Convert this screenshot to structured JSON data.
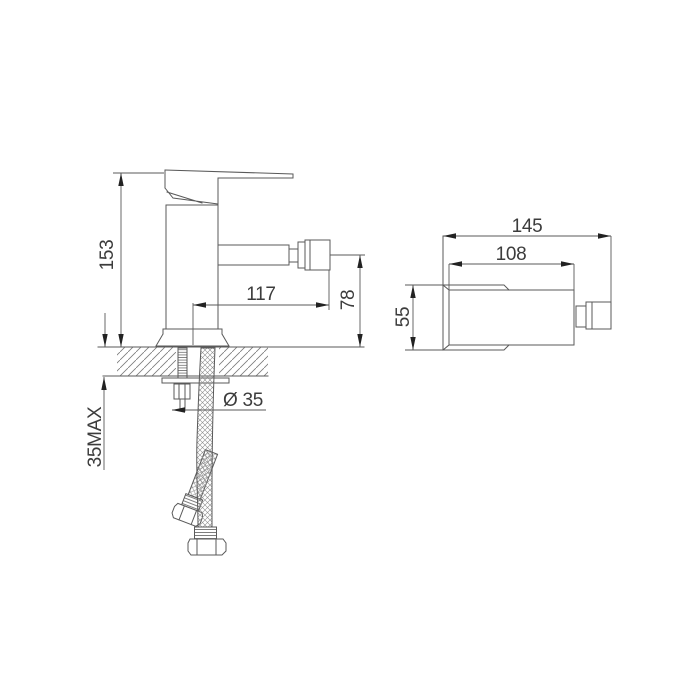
{
  "drawing": {
    "front_view": {
      "dim_height": "153",
      "dim_spout_reach": "117",
      "dim_spout_height": "78",
      "dim_max_deck_thickness": "35MAX",
      "dim_hole_diameter": "Ø 35"
    },
    "top_view": {
      "dim_overall_length": "145",
      "dim_body_length": "108",
      "dim_body_width": "55"
    },
    "colors": {
      "line": "#5a5a5a",
      "text": "#3c3c3c",
      "arrow": "#222222",
      "background": "#ffffff"
    }
  }
}
